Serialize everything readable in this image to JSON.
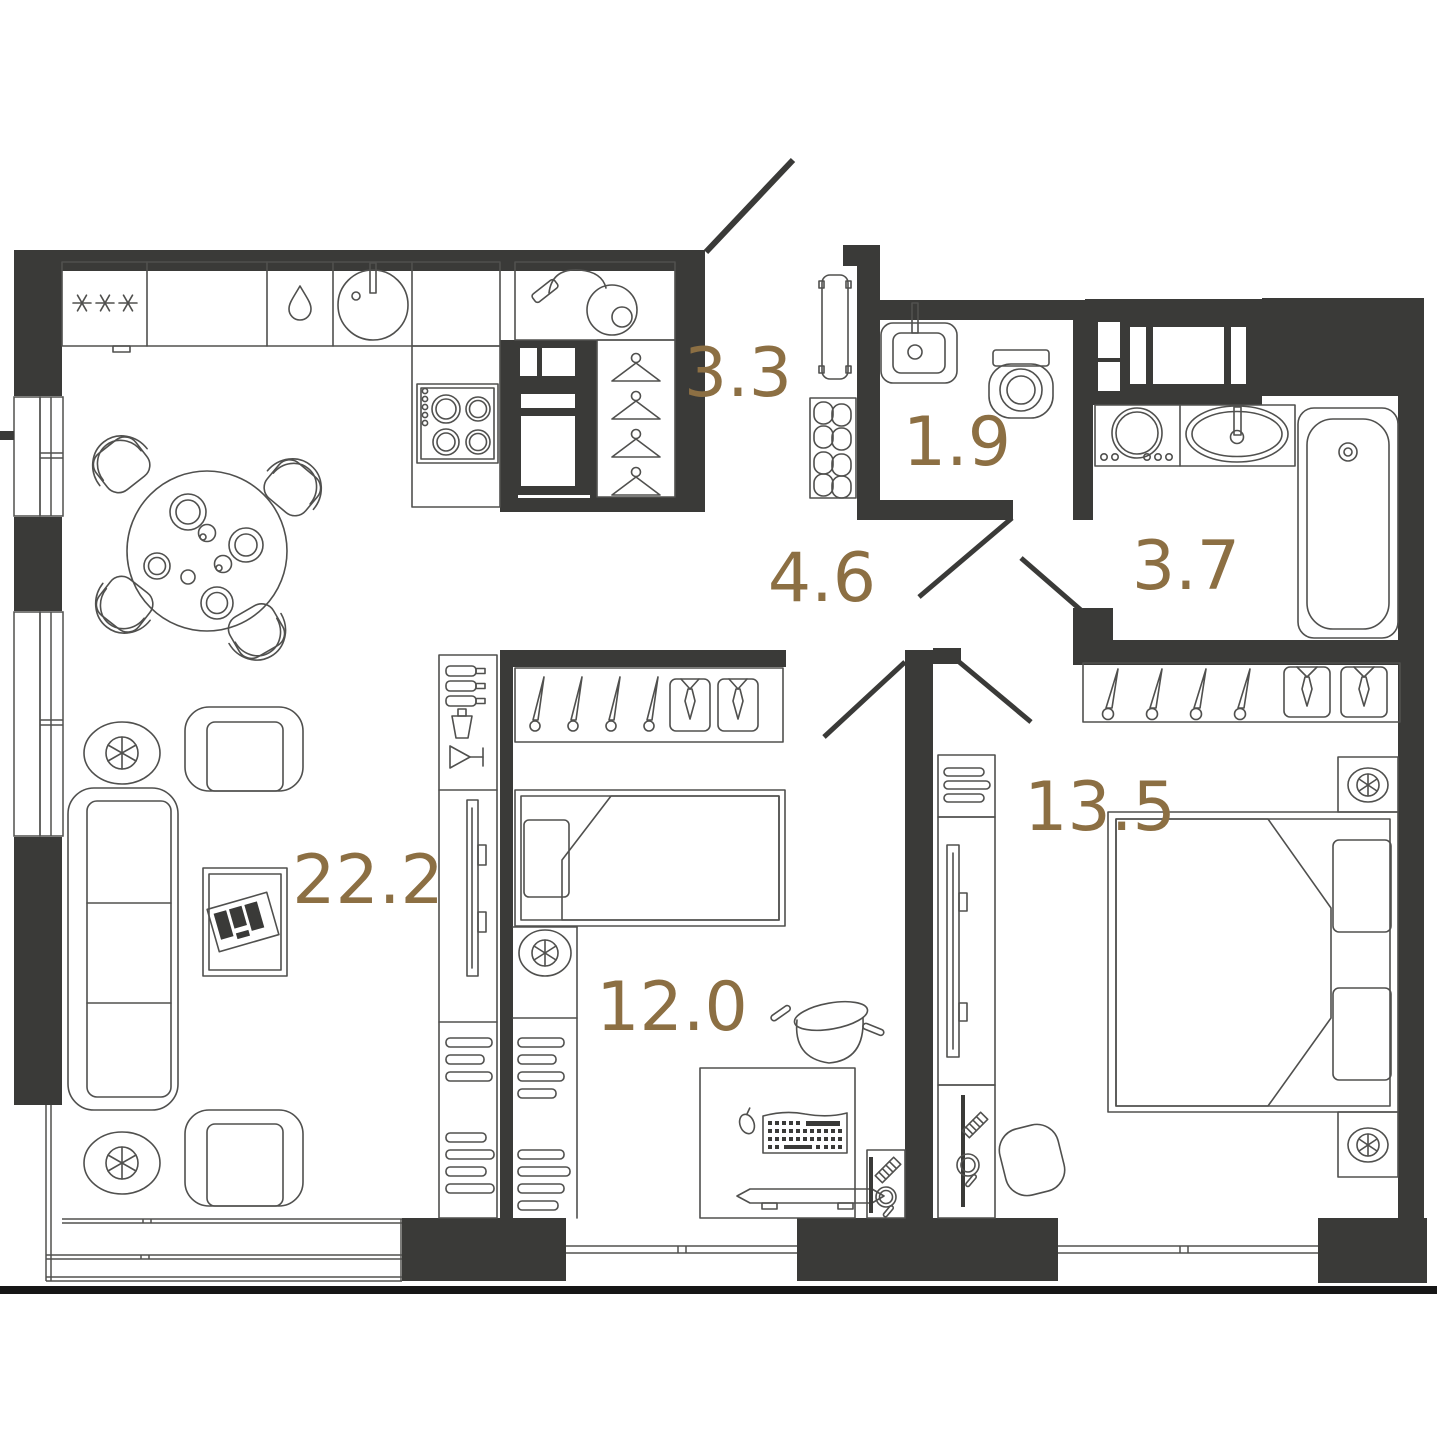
{
  "plan": {
    "rooms": [
      {
        "id": "kitchen-living-room",
        "area": "22.2"
      },
      {
        "id": "hallway",
        "area": "3.3"
      },
      {
        "id": "wc",
        "area": "1.9"
      },
      {
        "id": "corridor",
        "area": "4.6"
      },
      {
        "id": "bathroom",
        "area": "3.7"
      },
      {
        "id": "bedroom-1",
        "area": "12.0"
      },
      {
        "id": "bedroom-2",
        "area": "13.5"
      }
    ],
    "colors": {
      "wall": "#3a3a38",
      "line": "#50504e",
      "label": "#8c6f43",
      "background": "#ffffff",
      "baseline": "#161616"
    }
  }
}
